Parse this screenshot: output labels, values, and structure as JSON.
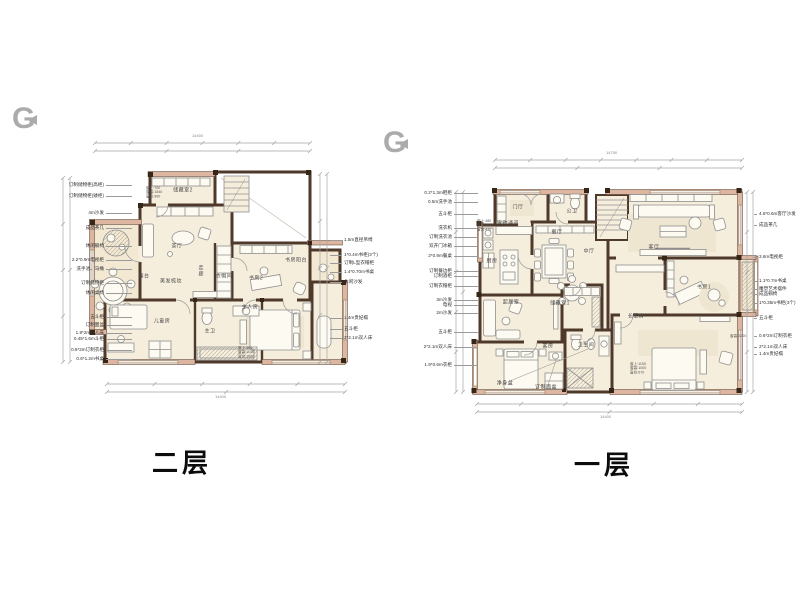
{
  "watermark": {
    "letter": "G"
  },
  "plans": [
    {
      "id": "second-floor",
      "caption": "二层",
      "rooms": [
        "储藏室2",
        "茶厅",
        "露台",
        "走廊",
        "美发梳妆",
        "衣帽间",
        "书房2",
        "书房阳台",
        "儿童房",
        "主卫",
        "主人房"
      ],
      "annotations_left": [
        "订制储物柜(高柜)",
        "订制储物柜(矮柜)",
        "4m沙发",
        "成品茶几",
        "休闲躺椅",
        "2.2*0.9m电视柜",
        "洗手池、马桶",
        "订制储物柜",
        "休闲桌椅",
        "五斗柜",
        "订制面盆",
        "1.9*2m双人床",
        "0.45*1.6m斗柜",
        "0.9*2m订制衣柜",
        "0.6*1.2m书桌"
      ],
      "annotations_right": [
        "1.5m直径吊椅",
        "1*0.4m书柜(3个)",
        "订制L型衣帽柜",
        "1.4*0.70m书桌",
        "休闲沙发",
        "1.4m贵妃榻",
        "五斗柜",
        "2*2.1m双人床"
      ],
      "window_specs": [
        [
          "窗上:700",
          "窗高:1540",
          "窗台:900"
        ],
        [
          "窗上:485",
          "窗高:1140",
          "窗台:1000"
        ]
      ],
      "dims": {
        "top_total": "14400",
        "bottom_total": "14400"
      }
    },
    {
      "id": "first-floor",
      "caption": "一层",
      "rooms": [
        "门厅",
        "公卫",
        "家政通道",
        "餐厅",
        "厨房",
        "中厅",
        "客厅",
        "书房1",
        "起居室",
        "储藏室1",
        "客房",
        "卫生间",
        "长辈房"
      ],
      "fixtures": [
        "净身盆",
        "订制面盆"
      ],
      "annotations_left": [
        "0.2*1.3m鞋柜",
        "0.5m洗手池",
        "五斗柜",
        "洗衣机",
        "订制洗衣池",
        "双开门冰箱",
        "2*0.9m餐桌",
        "订制餐边柜",
        "订制酒柜",
        "订制衣帽柜",
        "3m沙发",
        "电视",
        "2m沙发",
        "五斗柜",
        "2*2.1m双人床",
        "1.9*0.6m衣柜"
      ],
      "annotations_right": [
        "4.6*0.6m客厅沙发",
        "成品茶几",
        "3.6m电视柜",
        "1.1*0.7m书桌",
        "雕塑艺术摆件",
        "成品躺椅",
        "1*0.35m书柜(3个)",
        "五斗柜",
        "0.6*2m订制衣柜",
        "2*2.1m双人床",
        "1.4m贵妃榻"
      ],
      "window_specs": [
        [
          "窗上:480",
          "窗高:1440",
          "窗台:470"
        ],
        [
          "窗上:1150",
          "窗高:1000",
          "窗台:670"
        ],
        [
          "窗高:2200"
        ]
      ],
      "dims": {
        "top_total": "14750",
        "bottom_total": "14400"
      }
    }
  ]
}
